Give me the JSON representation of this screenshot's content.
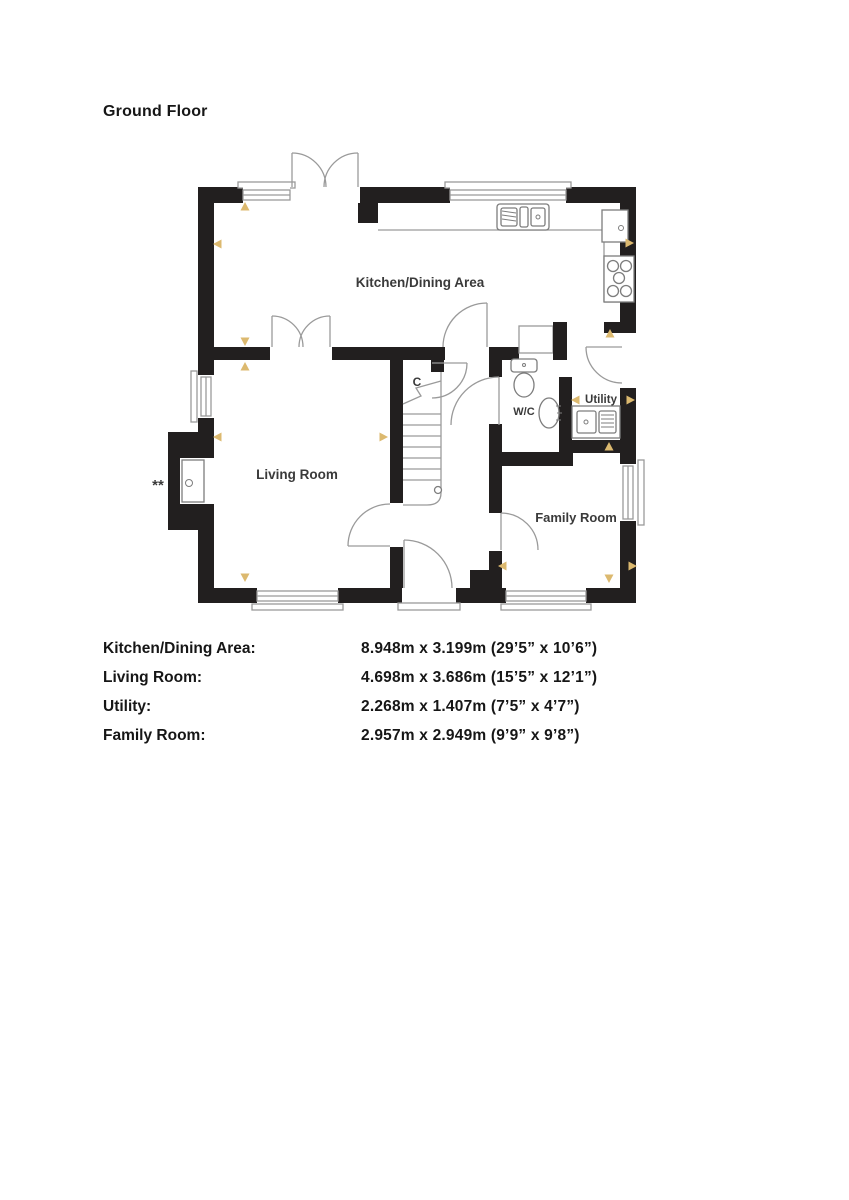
{
  "page": {
    "title": "Ground Floor"
  },
  "floor_plan": {
    "rooms": {
      "kitchen_dining": "Kitchen/Dining Area",
      "living_room": "Living Room",
      "family_room": "Family Room",
      "utility": "Utility",
      "wc": "W/C",
      "cupboard": "C"
    },
    "footnote_marker": "**",
    "colors": {
      "wall": "#221f1f",
      "plan_line": "#9a9a9a",
      "marker": "#dcb96f",
      "label": "#3a3a3a"
    },
    "dimension_markers": [
      {
        "x": 245,
        "y": 207,
        "d": "up"
      },
      {
        "x": 218,
        "y": 244,
        "d": "left"
      },
      {
        "x": 629,
        "y": 243,
        "d": "right"
      },
      {
        "x": 245,
        "y": 341,
        "d": "down"
      },
      {
        "x": 245,
        "y": 367,
        "d": "up"
      },
      {
        "x": 610,
        "y": 334,
        "d": "up"
      },
      {
        "x": 218,
        "y": 437,
        "d": "left"
      },
      {
        "x": 383,
        "y": 437,
        "d": "right"
      },
      {
        "x": 576,
        "y": 400,
        "d": "left"
      },
      {
        "x": 630,
        "y": 400,
        "d": "right"
      },
      {
        "x": 609,
        "y": 447,
        "d": "up"
      },
      {
        "x": 503,
        "y": 566,
        "d": "left"
      },
      {
        "x": 632,
        "y": 566,
        "d": "right"
      },
      {
        "x": 609,
        "y": 578,
        "d": "down"
      },
      {
        "x": 245,
        "y": 577,
        "d": "down"
      }
    ]
  },
  "dimensions_table": {
    "rows": [
      {
        "label": "Kitchen/Dining Area:",
        "value": "8.948m x 3.199m (29’5” x 10’6”)"
      },
      {
        "label": "Living Room:",
        "value": "4.698m x 3.686m (15’5” x 12’1”)"
      },
      {
        "label": "Utility:",
        "value": "2.268m x 1.407m (7’5” x 4’7”)"
      },
      {
        "label": "Family Room:",
        "value": "2.957m x 2.949m (9’9” x 9’8”)"
      }
    ]
  }
}
